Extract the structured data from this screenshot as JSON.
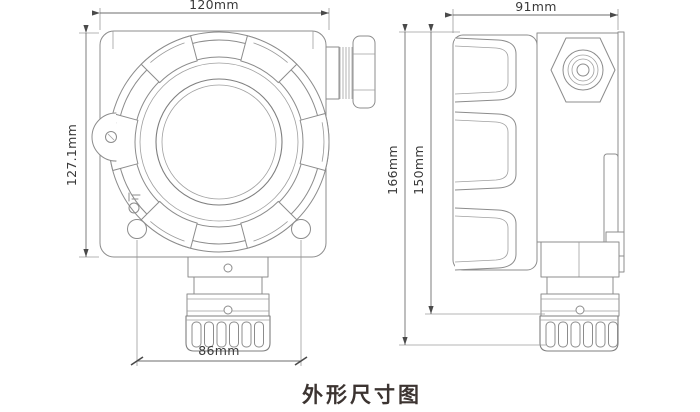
{
  "caption": "外形尺寸图",
  "colors": {
    "background": "#ffffff",
    "drawing_line": "#8c8c8c",
    "dimension_line": "#6e6e6e",
    "dimension_text": "#3a3a3a",
    "caption_text": "#3c3431"
  },
  "views": {
    "front": {
      "label": "front-view",
      "dimensions": {
        "width_top": "120mm",
        "height_left": "127.1mm",
        "hole_spacing_bottom": "86mm"
      }
    },
    "side": {
      "label": "side-view",
      "dimensions": {
        "width_top": "91mm",
        "height_overall": "166mm",
        "height_body": "150mm"
      }
    }
  }
}
